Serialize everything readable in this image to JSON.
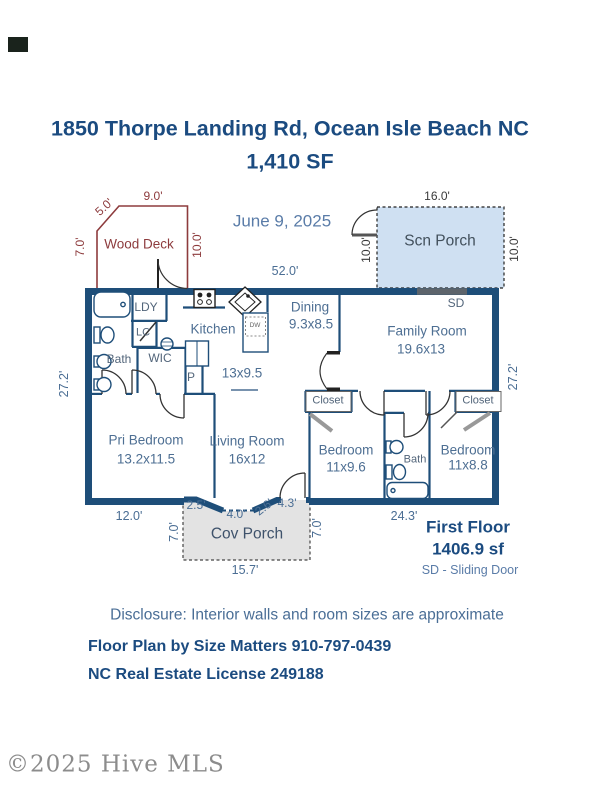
{
  "title": {
    "address": "1850 Thorpe Landing Rd, Ocean Isle Beach NC",
    "size": "1,410 SF"
  },
  "date": "June 9, 2025",
  "wood_deck": {
    "name": "Wood Deck",
    "dim_top": "9.0'",
    "dim_diagonal": "5.0'",
    "dim_left": "7.0'",
    "dim_right": "10.0'"
  },
  "scn_porch": {
    "name": "Scn Porch",
    "dim_top": "16.0'",
    "dim_left": "10.0'",
    "dim_right": "10.0'"
  },
  "house": {
    "dim_top": "52.0'",
    "dim_left": "27.2'",
    "dim_right": "27.2'",
    "dim_bottom_left": "12.0'",
    "dim_bottom_right": "24.3'"
  },
  "rooms": {
    "ldy": "LDY",
    "lc": "LC",
    "bath_primary": "Bath",
    "wic": "WIC",
    "pantry": "P",
    "dishwasher": "DW",
    "sliding_door": "SD",
    "kitchen": {
      "name": "Kitchen",
      "dim": "13x9.5"
    },
    "dining": {
      "name": "Dining",
      "dim": "9.3x8.5"
    },
    "family": {
      "name": "Family Room",
      "dim": "19.6x13"
    },
    "pri_bedroom": {
      "name": "Pri Bedroom",
      "dim": "13.2x11.5"
    },
    "living": {
      "name": "Living Room",
      "dim": "16x12"
    },
    "bedroom_left": {
      "name": "Bedroom",
      "dim": "11x9.6"
    },
    "bedroom_right": {
      "name": "Bedroom",
      "dim": "11x8.8"
    },
    "bath_hall": "Bath",
    "closet_left": "Closet",
    "closet_right": "Closet"
  },
  "cov_porch": {
    "name": "Cov Porch",
    "seg_1": "2.5'",
    "seg_2": "4.0'",
    "seg_3": "2.6'",
    "seg_4": "4.3'",
    "dim_left": "7.0'",
    "dim_right": "7.0'",
    "dim_bottom": "15.7'"
  },
  "summary": {
    "floor_name": "First Floor",
    "floor_area": "1406.9 sf",
    "legend": "SD - Sliding Door"
  },
  "footer": {
    "disclosure": "Disclosure: Interior walls and room sizes are approximate",
    "attribution": "Floor Plan by Size Matters 910-797-0439",
    "license": "NC Real Estate License 249188"
  },
  "watermark": "©2025 Hive MLS",
  "colors": {
    "wall": "#1e4e79",
    "label": "#4b6e94",
    "title": "#1b4b80",
    "deck_outline": "#8d3b3d",
    "scn_porch_fill": "#cfe0f2",
    "cov_porch_fill": "#e3e3e3"
  }
}
